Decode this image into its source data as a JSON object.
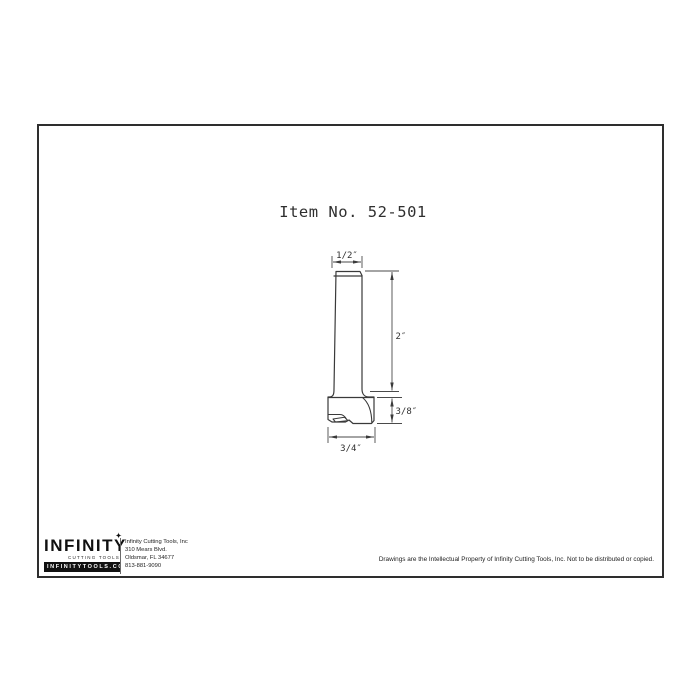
{
  "drawing": {
    "title": "Item No. 52-501",
    "dimensions": {
      "shank_diameter": "1/2″",
      "shank_length": "2″",
      "cutter_height": "3/8″",
      "cutter_diameter": "3/4″"
    },
    "line_color": "#3a3a3a"
  },
  "title_block": {
    "logo": {
      "name": "INFINITY",
      "tagline": "CUTTING TOOLS",
      "website": "INFINITYTOOLS.COM",
      "star_glyph": "✦"
    },
    "address": {
      "company": "Infinity Cutting Tools, Inc",
      "street": "310 Mears Blvd.",
      "city": "Oldsmar, FL  34677",
      "phone": "813-881-9090"
    },
    "disclaimer": "Drawings are the Intellectual Property of Infinity Cutting Tools, Inc. Not to be distributed or copied."
  }
}
